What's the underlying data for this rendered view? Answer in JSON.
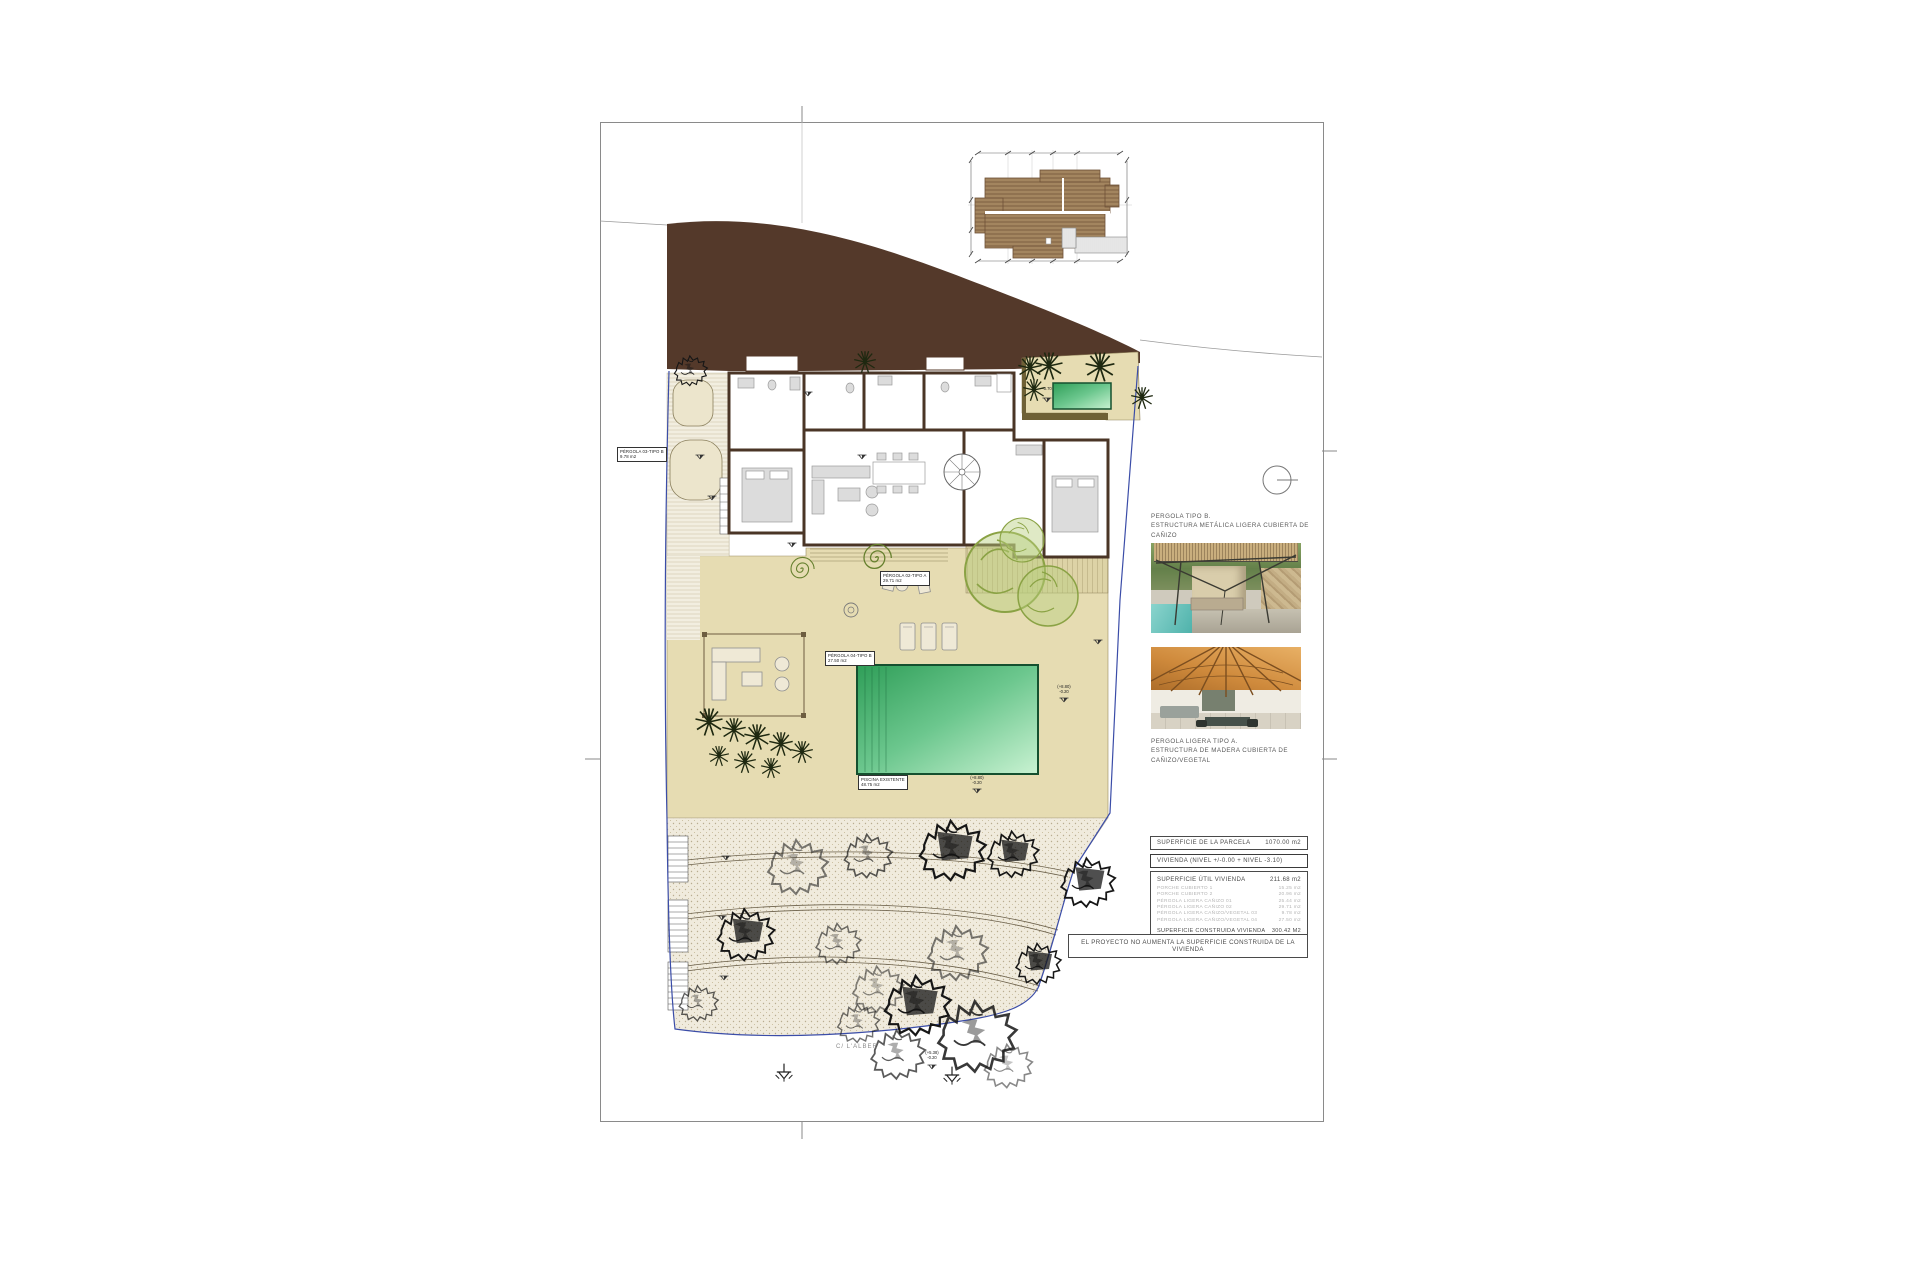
{
  "colors": {
    "roadway_brown": "#54392a",
    "terrace_beige": "#e6dcb2",
    "pool_green_dark": "#2f9e58",
    "pool_green_light": "#c9f2d2",
    "boundary_blue": "#3b4da8",
    "wall_brown": "#4a3526"
  },
  "plan": {
    "street_label": "C/ L'ALBER",
    "labels": {
      "pergola03": {
        "l1": "PÉRGOLA 03-TIPO B",
        "l2": "9.78 m2"
      },
      "pergola02": {
        "l1": "PÉRGOLA 02-TIPO A",
        "l2": "29.71 m2"
      },
      "pergola04": {
        "l1": "PÉRGOLA 04-TIPO B",
        "l2": "27.50 m2"
      },
      "piscina": {
        "l1": "PISCINA EXISTENTE",
        "l2": "48.75 m2"
      }
    },
    "levels": {
      "spa": {
        "t1": "-3.70",
        "t2": ""
      },
      "pool_right": {
        "t1": "(+8.80)",
        "t2": "-0.20"
      },
      "pool_bottom": {
        "t1": "(+8.80)",
        "t2": "-0.20"
      },
      "street": {
        "t1": "(+5.38)",
        "t2": "-0.20"
      }
    }
  },
  "panel": {
    "photo1_caption_line1": "PERGOLA TIPO B.",
    "photo1_caption_line2": "ESTRUCTURA METÁLICA LIGERA CUBIERTA DE CAÑIZO",
    "photo2_caption_line1": "PERGOLA LIGERA TIPO A.",
    "photo2_caption_line2": "ESTRUCTURA DE MADERA CUBIERTA DE CAÑIZO/VEGETAL",
    "table": {
      "parcela_label": "SUPERFICIE DE LA PARCELA",
      "parcela_value": "1070.00 m2",
      "vivienda_header": "VIVIENDA (NIVEL +/-0.00 + NIVEL -3.10)",
      "util_label": "SUPERFICIE ÚTIL VIVIENDA",
      "util_value": "211.68 m2",
      "rows": [
        {
          "label": "PORCHE CUBIERTO 1",
          "value": "15.25 m2"
        },
        {
          "label": "PORCHE CUBIERTO 2",
          "value": "20.96 m2"
        },
        {
          "label": "PÉRGOLA LIGERA CAÑIZO 01",
          "value": "25.44 m2"
        },
        {
          "label": "PÉRGOLA LIGERA CAÑIZO 02",
          "value": "29.71 m2"
        },
        {
          "label": "PÉRGOLA LIGERA CAÑIZO/VEGETAL 03",
          "value": "9.78 m2"
        },
        {
          "label": "PÉRGOLA LIGERA CAÑIZO/VEGETAL 04",
          "value": "27.50 m2"
        }
      ],
      "construida_label": "SUPERFICIE CONSTRUIDA VIVIENDA",
      "construida_value": "300.42 M2"
    },
    "banner": "EL PROYECTO NO AUMENTA LA SUPERFICIE CONSTRUIDA DE LA VIVIENDA"
  }
}
